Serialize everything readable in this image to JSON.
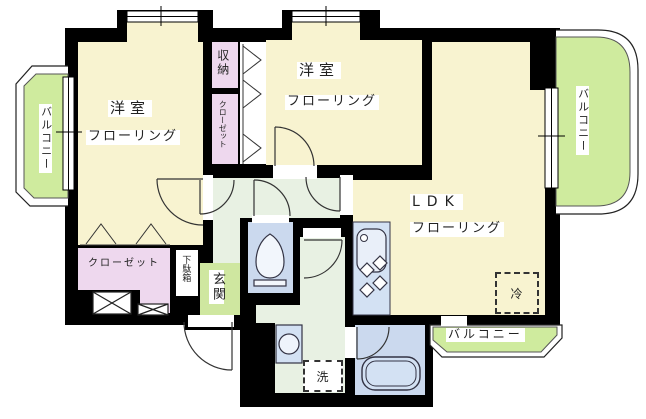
{
  "plan_type": "apartment-floor-plan",
  "rooms": {
    "bedroom_left": {
      "name": "洋室",
      "floor": "フローリング"
    },
    "bedroom_center": {
      "name": "洋室",
      "floor": "フローリング"
    },
    "ldk": {
      "name": "LDK",
      "floor": "フローリング"
    }
  },
  "features": {
    "storage": "収納",
    "closet_side": "クローゼット",
    "closet_bottom": "クローゼット",
    "shoe_cabinet": "下駄箱",
    "entrance": "玄関",
    "washer": "洗",
    "fridge": "冷",
    "balcony_left": "バルコニー",
    "balcony_right": "バルコニー",
    "balcony_bottom": "バルコニー"
  },
  "colors": {
    "wall": "#000000",
    "flooring": "#f8f3d0",
    "closet": "#eed8ee",
    "hallway": "#e8f1e3",
    "entrance_floor": "#cfe7a0",
    "balcony": "#cfeb9e",
    "sanitary": "#cbd9ee",
    "kitchen": "#d3e1f3"
  }
}
